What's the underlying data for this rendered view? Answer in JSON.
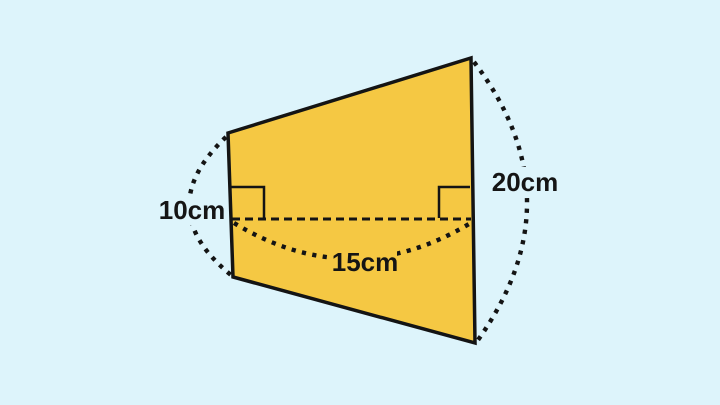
{
  "diagram": {
    "title": "Trapezoid with measurements",
    "background_color": "#DDF4FB",
    "shape": {
      "name": "trapezoid",
      "fill_color": "#F5C843",
      "outline_color": "#141414"
    },
    "labels": {
      "left_height": "10cm",
      "right_height": "20cm",
      "middle_width": "15cm"
    },
    "measurements": {
      "left_height_cm": 10,
      "right_height_cm": 20,
      "middle_width_cm": 15
    }
  }
}
